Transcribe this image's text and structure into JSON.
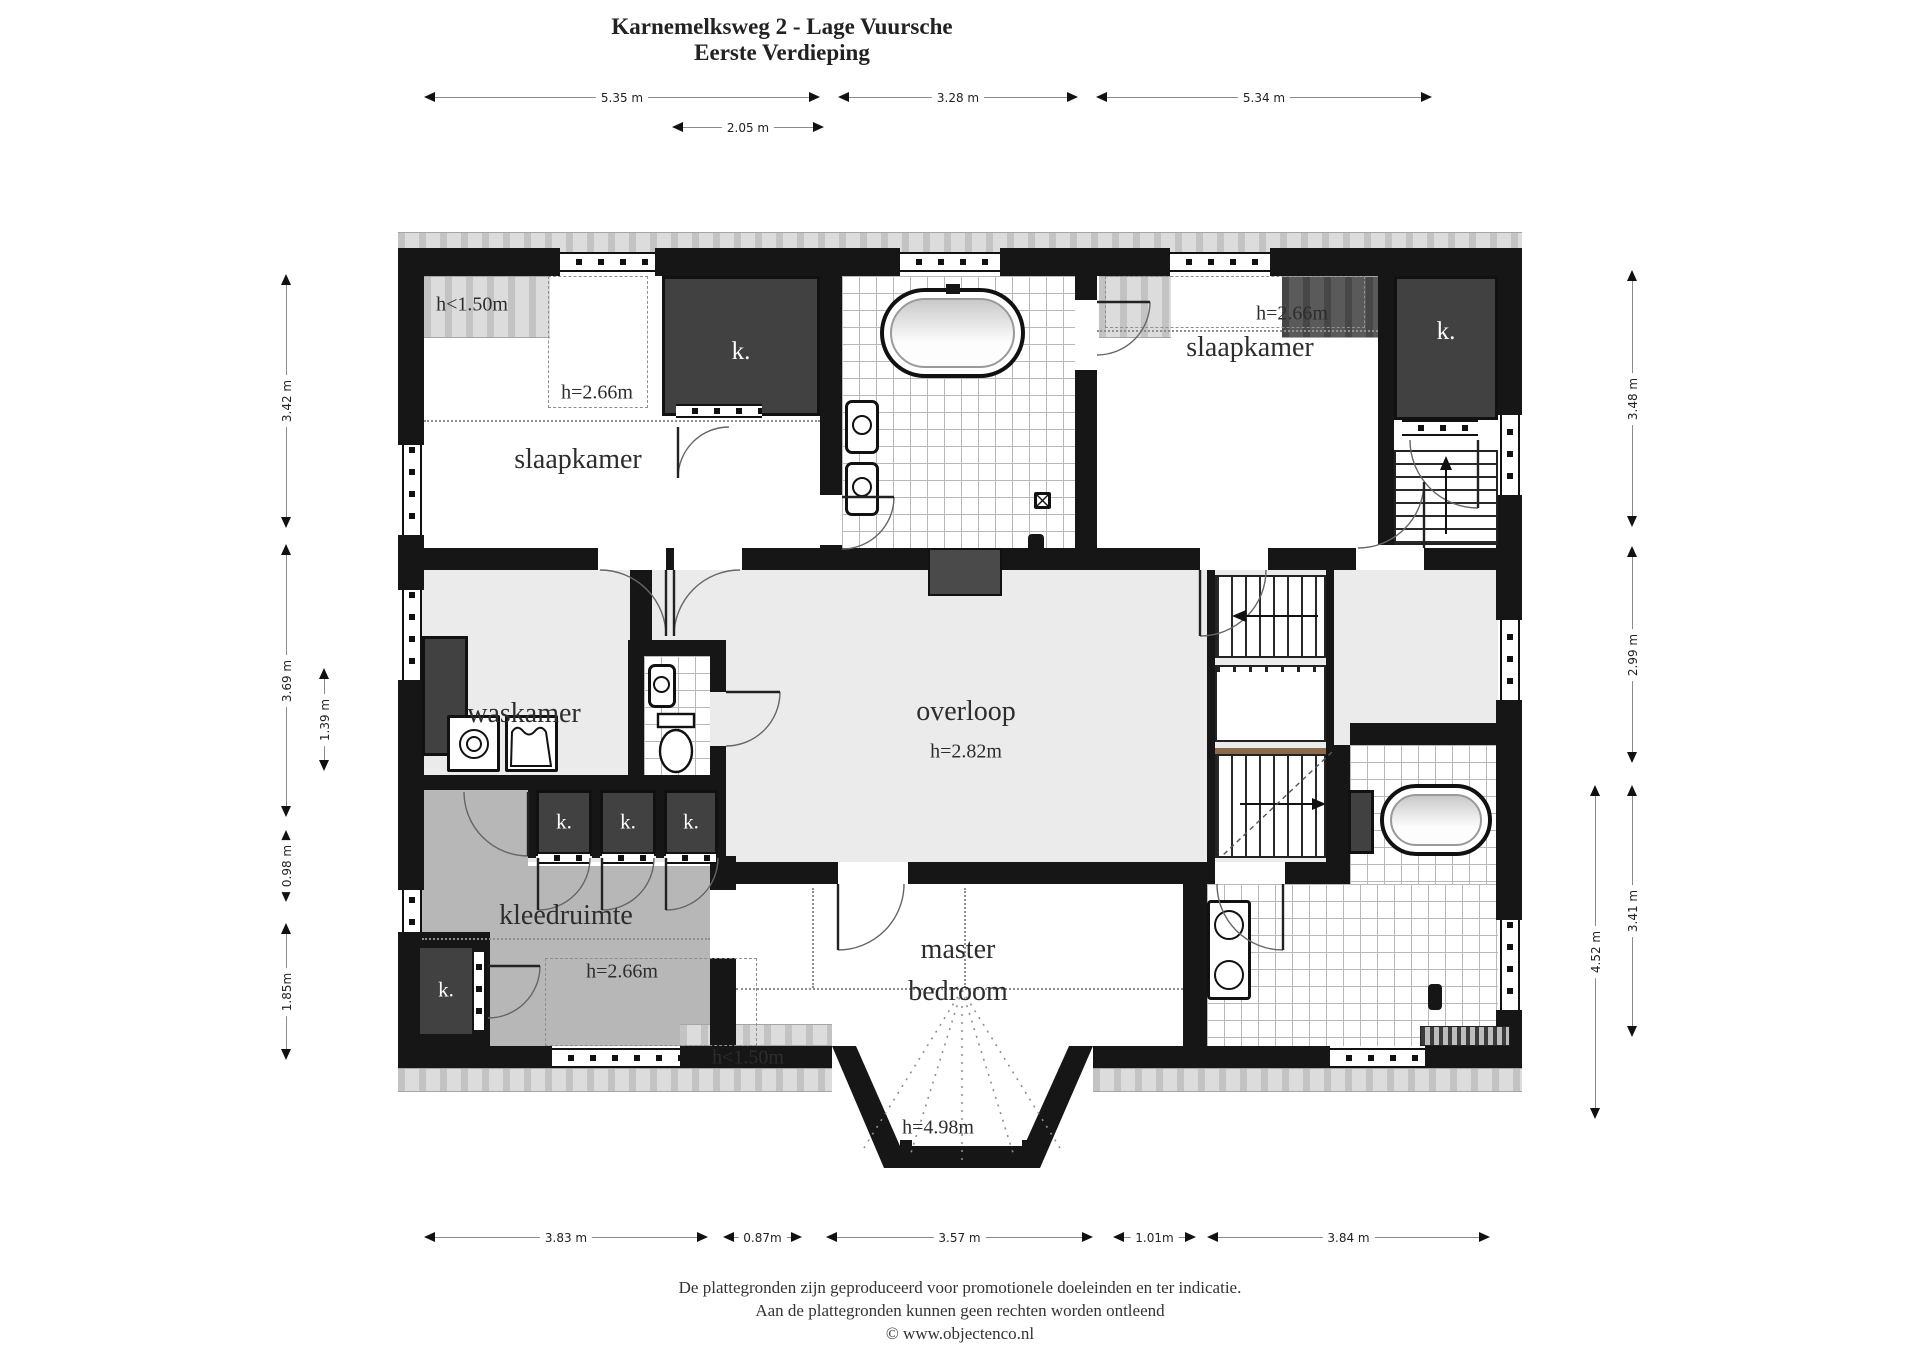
{
  "title": {
    "line1": "Karnemelksweg 2 - Lage Vuursche",
    "line2": "Eerste Verdieping"
  },
  "rooms": {
    "slaapkamer_left": {
      "label": "slaapkamer",
      "ceiling": "h=2.66m",
      "eave": "h<1.50m"
    },
    "slaapkamer_right": {
      "label": "slaapkamer",
      "ceiling": "h=2.66m"
    },
    "waskamer": {
      "label": "waskamer"
    },
    "overloop": {
      "label": "overloop",
      "ceiling": "h=2.82m"
    },
    "kleedruimte": {
      "label": "kleedruimte",
      "ceiling": "h=2.66m",
      "eave": "h<1.50m"
    },
    "master_bedroom": {
      "label_line1": "master",
      "label_line2": "bedroom",
      "ceiling": "h=4.98m"
    }
  },
  "closets": {
    "bedroom_left": "k.",
    "bedroom_right": "k.",
    "hall_1": "k.",
    "hall_2": "k.",
    "hall_3": "k.",
    "kleedruimte": "k."
  },
  "dimensions": {
    "top": [
      "5.35 m",
      "3.28 m",
      "5.34 m"
    ],
    "top_inner": "2.05 m",
    "left": [
      "3.42 m",
      "3.69 m",
      "0.98 m",
      "1.85m"
    ],
    "left_inner": "1.39 m",
    "right": [
      "3.48 m",
      "2.99 m",
      "3.41 m"
    ],
    "right_outer": "4.52 m",
    "bottom": [
      "3.83 m",
      "0.87m",
      "3.57 m",
      "1.01m",
      "3.84 m"
    ]
  },
  "footer": {
    "line1": "De plattegronden zijn geproduceerd voor promotionele doeleinden en ter indicatie.",
    "line2": "Aan de plattegronden kunnen geen rechten worden ontleend",
    "line3": "© www.objectenco.nl"
  }
}
